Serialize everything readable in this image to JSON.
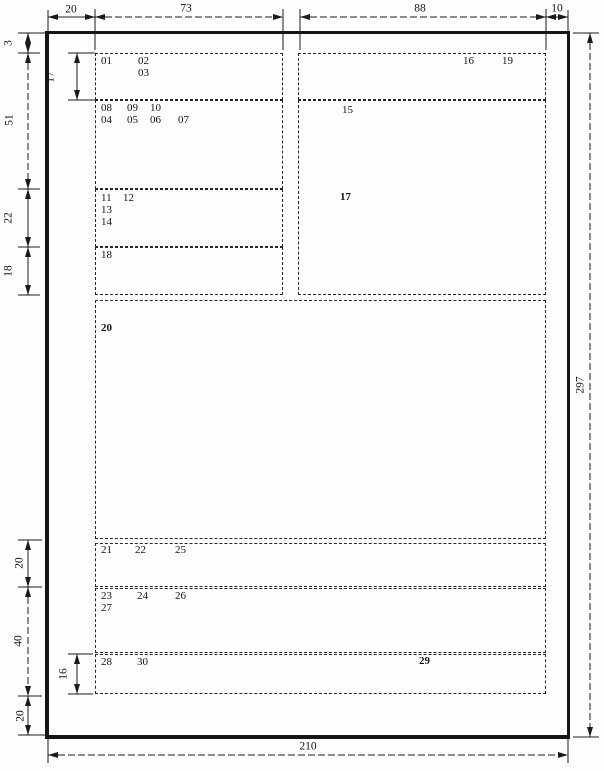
{
  "dims": {
    "top": {
      "d20": "20",
      "d73": "73",
      "d88": "88",
      "d10": "10"
    },
    "left_upper": {
      "d3": "3",
      "d17": "17",
      "d51": "51",
      "d22": "22",
      "d18": "18"
    },
    "left_lower": {
      "d20a": "20",
      "d40": "40",
      "d16": "16",
      "d20b": "20"
    },
    "right": {
      "d297": "297"
    },
    "bottom": {
      "d210": "210"
    }
  },
  "zones": {
    "z01": "01",
    "z02": "02",
    "z03": "03",
    "z04": "04",
    "z05": "05",
    "z06": "06",
    "z07": "07",
    "z08": "08",
    "z09": "09",
    "z10": "10",
    "z11": "11",
    "z12": "12",
    "z13": "13",
    "z14": "14",
    "z15": "15",
    "z16": "16",
    "z17": "17",
    "z18": "18",
    "z19": "19",
    "z20": "20",
    "z21": "21",
    "z22": "22",
    "z23": "23",
    "z24": "24",
    "z25": "25",
    "z26": "26",
    "z27": "27",
    "z28": "28",
    "z29": "29",
    "z30": "30"
  }
}
